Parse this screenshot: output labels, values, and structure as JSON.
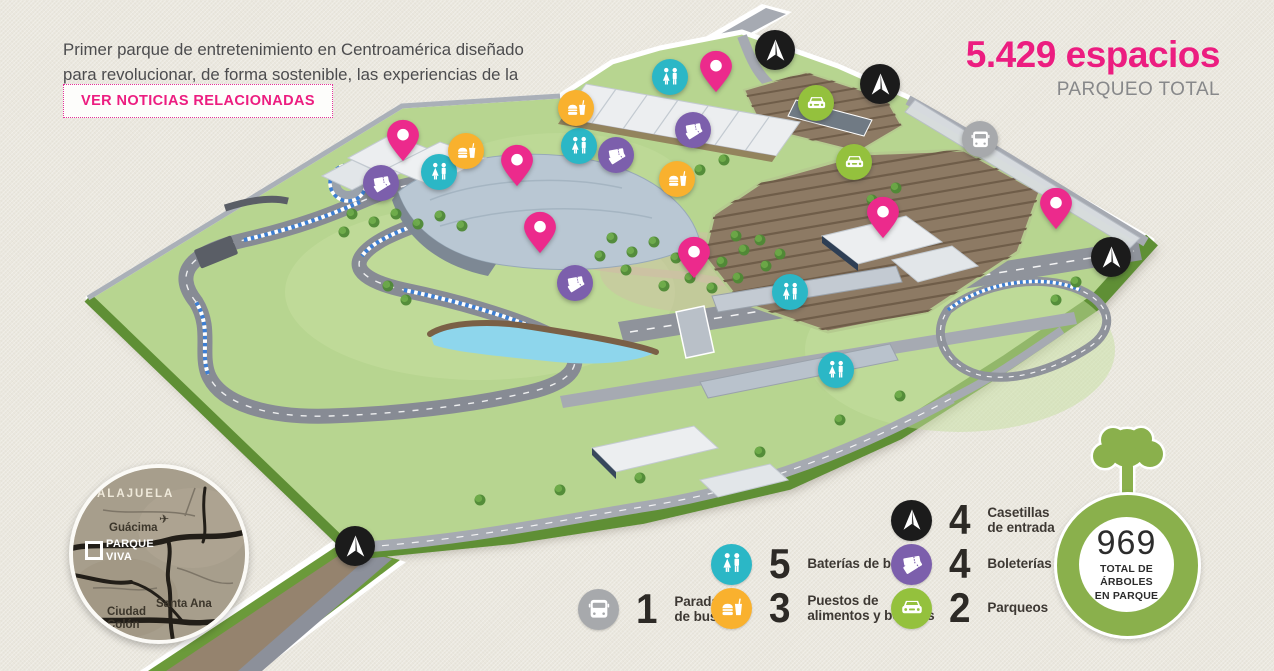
{
  "header": {
    "intro": "Primer parque de entretenimiento en Centroamérica diseñado para revolucionar, de forma sostenible, las experiencias de la región.",
    "news_button": "VER NOTICIAS RELACIONADAS"
  },
  "parking_stat": {
    "value": "5.429 espacios",
    "label": "PARQUEO TOTAL"
  },
  "tree_stat": {
    "value": "969",
    "label": "TOTAL DE\nÁRBOLES\nEN PARQUE"
  },
  "inset_map": {
    "alajuela": "ALAJUELA",
    "guacima": "Guácima",
    "parque_viva": "PARQUE\nVIVA",
    "santa_ana": "Santa Ana",
    "ciudad_colon": "Ciudad\nColón"
  },
  "legend": {
    "items": [
      {
        "id": "parada-de-buses",
        "icon": "bus",
        "color": "#a7a9ac",
        "count": "1",
        "label": "Parada\nde buses"
      },
      {
        "id": "baterias-de-banos",
        "icon": "banos",
        "color": "#2bb7c6",
        "count": "5",
        "label": "Baterías de baños"
      },
      {
        "id": "puestos-alimentos",
        "icon": "alimentos",
        "color": "#f9b12e",
        "count": "3",
        "label": "Puestos de\nalimentos y bebidas"
      },
      {
        "id": "casetillas-entrada",
        "icon": "casetilla",
        "color": "#1b1b1b",
        "count": "4",
        "label": "Casetillas\nde entrada"
      },
      {
        "id": "boleterias",
        "icon": "boleteria",
        "color": "#7c5fac",
        "count": "4",
        "label": "Boleterías"
      },
      {
        "id": "parqueos",
        "icon": "parqueo",
        "color": "#94c13d",
        "count": "2",
        "label": "Parqueos"
      }
    ]
  },
  "map": {
    "marker_colors": {
      "pin": "#ec2a8c",
      "banos": "#2bb7c6",
      "alimentos": "#f9b12e",
      "boleteria": "#7c5fac",
      "parqueo": "#94c13d",
      "bus": "#a7a9ac",
      "casetilla": "#1b1b1b"
    },
    "markers": [
      {
        "type": "pin",
        "x": 403,
        "y": 140
      },
      {
        "type": "pin",
        "x": 517,
        "y": 165
      },
      {
        "type": "pin",
        "x": 716,
        "y": 71
      },
      {
        "type": "pin",
        "x": 540,
        "y": 232
      },
      {
        "type": "pin",
        "x": 694,
        "y": 257
      },
      {
        "type": "pin",
        "x": 883,
        "y": 217
      },
      {
        "type": "pin",
        "x": 1056,
        "y": 208
      },
      {
        "type": "banos",
        "x": 670,
        "y": 77
      },
      {
        "type": "banos",
        "x": 579,
        "y": 146
      },
      {
        "type": "banos",
        "x": 439,
        "y": 172
      },
      {
        "type": "banos",
        "x": 790,
        "y": 292
      },
      {
        "type": "banos",
        "x": 836,
        "y": 370
      },
      {
        "type": "alimentos",
        "x": 576,
        "y": 108
      },
      {
        "type": "alimentos",
        "x": 466,
        "y": 151
      },
      {
        "type": "alimentos",
        "x": 677,
        "y": 179
      },
      {
        "type": "boleteria",
        "x": 693,
        "y": 130
      },
      {
        "type": "boleteria",
        "x": 616,
        "y": 155
      },
      {
        "type": "boleteria",
        "x": 381,
        "y": 183
      },
      {
        "type": "boleteria",
        "x": 575,
        "y": 283
      },
      {
        "type": "parqueo",
        "x": 816,
        "y": 103
      },
      {
        "type": "parqueo",
        "x": 854,
        "y": 162
      },
      {
        "type": "bus",
        "x": 980,
        "y": 139
      },
      {
        "type": "casetilla",
        "x": 775,
        "y": 50
      },
      {
        "type": "casetilla",
        "x": 880,
        "y": 84
      },
      {
        "type": "casetilla",
        "x": 1111,
        "y": 257
      },
      {
        "type": "casetilla",
        "x": 355,
        "y": 546
      }
    ]
  }
}
